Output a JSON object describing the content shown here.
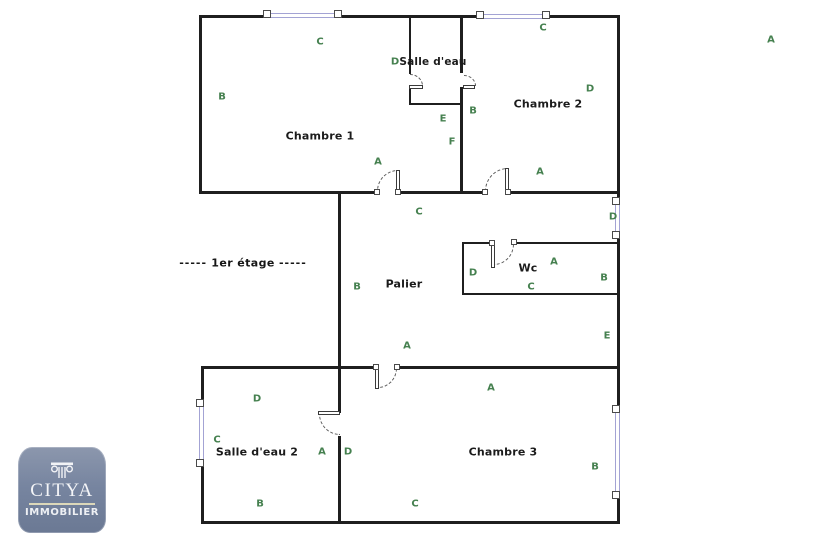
{
  "plan": {
    "floor_label": "1er étage",
    "floor_label_dashes": "-----",
    "rooms": {
      "chambre1": "Chambre 1",
      "salle_deau": "Salle d'eau",
      "chambre2": "Chambre 2",
      "palier": "Palier",
      "wc": "Wc",
      "salle_deau2": "Salle d'eau 2",
      "chambre3": "Chambre 3"
    },
    "markers": [
      {
        "label": "C",
        "x": 320,
        "y": 42,
        "area": "chambre1-top"
      },
      {
        "label": "B",
        "x": 222,
        "y": 97,
        "area": "chambre1-left"
      },
      {
        "label": "A",
        "x": 378,
        "y": 162,
        "area": "chambre1-door"
      },
      {
        "label": "D",
        "x": 395,
        "y": 62,
        "area": "salle-deau"
      },
      {
        "label": "E",
        "x": 443,
        "y": 119,
        "area": "salle-deau-below"
      },
      {
        "label": "F",
        "x": 452,
        "y": 142,
        "area": "salle-deau-below"
      },
      {
        "label": "C",
        "x": 543,
        "y": 28,
        "area": "chambre2-top"
      },
      {
        "label": "D",
        "x": 590,
        "y": 89,
        "area": "chambre2"
      },
      {
        "label": "B",
        "x": 473,
        "y": 111,
        "area": "chambre2-left"
      },
      {
        "label": "A",
        "x": 540,
        "y": 172,
        "area": "chambre2-door"
      },
      {
        "label": "A",
        "x": 771,
        "y": 40,
        "area": "page-top-right"
      },
      {
        "label": "C",
        "x": 419,
        "y": 212,
        "area": "palier-top"
      },
      {
        "label": "B",
        "x": 357,
        "y": 287,
        "area": "palier-left"
      },
      {
        "label": "A",
        "x": 407,
        "y": 346,
        "area": "palier-bottom"
      },
      {
        "label": "D",
        "x": 473,
        "y": 273,
        "area": "wc-left"
      },
      {
        "label": "A",
        "x": 554,
        "y": 262,
        "area": "wc"
      },
      {
        "label": "C",
        "x": 531,
        "y": 287,
        "area": "wc"
      },
      {
        "label": "B",
        "x": 604,
        "y": 278,
        "area": "wc-right"
      },
      {
        "label": "D",
        "x": 613,
        "y": 217,
        "area": "right-window"
      },
      {
        "label": "E",
        "x": 607,
        "y": 336,
        "area": "palier-right"
      },
      {
        "label": "D",
        "x": 257,
        "y": 399,
        "area": "salle-deau2-top"
      },
      {
        "label": "C",
        "x": 217,
        "y": 440,
        "area": "salle-deau2-left"
      },
      {
        "label": "A",
        "x": 322,
        "y": 452,
        "area": "salle-deau2-door"
      },
      {
        "label": "B",
        "x": 260,
        "y": 504,
        "area": "salle-deau2-bottom"
      },
      {
        "label": "D",
        "x": 348,
        "y": 452,
        "area": "chambre3-left"
      },
      {
        "label": "A",
        "x": 491,
        "y": 388,
        "area": "chambre3-top"
      },
      {
        "label": "B",
        "x": 595,
        "y": 467,
        "area": "chambre3-right"
      },
      {
        "label": "C",
        "x": 415,
        "y": 504,
        "area": "chambre3-bottom"
      }
    ],
    "colors": {
      "wall": "#1f1f1f",
      "marker_green": "#45804f",
      "window_lavender": "#a3a3d4"
    }
  },
  "logo": {
    "brand": "CITYA",
    "tagline": "IMMOBILIER",
    "badge_color": "#7785a0"
  }
}
